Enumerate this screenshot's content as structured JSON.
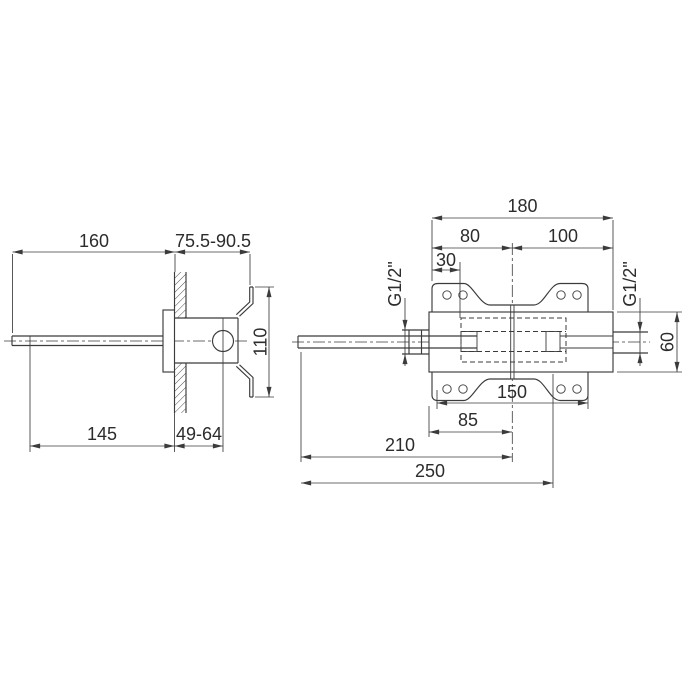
{
  "drawing": {
    "type": "technical-dimension-drawing",
    "background": "#ffffff",
    "line_color": "#3b3b3b",
    "text_color": "#2c2c2c",
    "side_view": {
      "dims": {
        "spout_length": "160",
        "wall_depth_range": "75.5-90.5",
        "plate_height": "110",
        "spout_reach": "145",
        "wall_to_handle_range": "49-64"
      }
    },
    "front_view": {
      "dims": {
        "overall_width": "180",
        "left_of_center": "80",
        "right_of_center": "100",
        "edge_to_inlet": "30",
        "inlet_thread_left": "G1/2\"",
        "inlet_thread_right": "G1/2\"",
        "body_height": "60",
        "plate_width": "150",
        "body_left_to_center": "85",
        "spout_tip_to_center": "210",
        "overall_length": "250"
      }
    }
  }
}
